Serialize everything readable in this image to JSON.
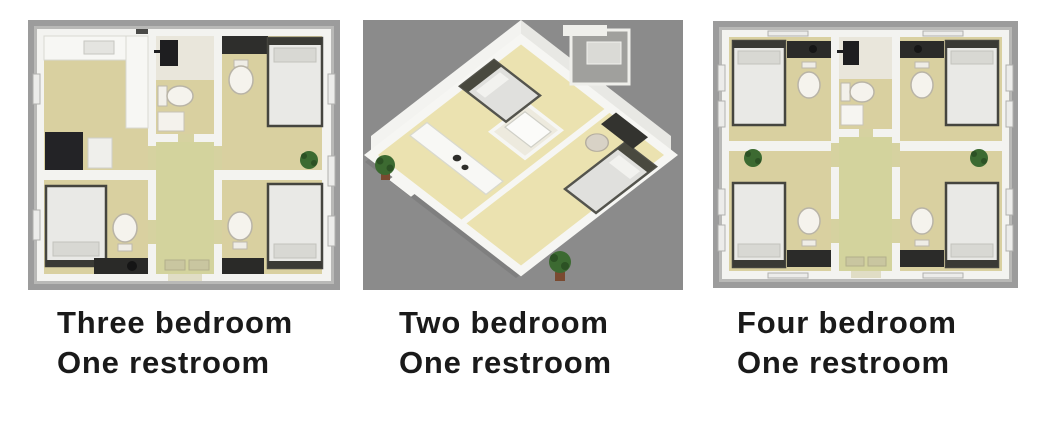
{
  "page": {
    "background_color": "#ffffff"
  },
  "panels": [
    {
      "name": "three-bedroom-plan",
      "view": "top-down floor plan",
      "caption_line1": "Three bedroom",
      "caption_line2": "One restroom",
      "features": [
        "bed-icon",
        "toilet-icon",
        "kitchen-counter-icon",
        "cabinet-icon",
        "plant-icon",
        "water-heater-icon",
        "corridor",
        "bathroom"
      ],
      "colors": {
        "frame": "#9c9c9c",
        "wall": "#f3f3f0",
        "floor": "#d9d0a0",
        "corridor_floor": "#d3d39d"
      }
    },
    {
      "name": "two-bedroom-plan",
      "view": "isometric 3d floor plan",
      "caption_line1": "Two bedroom",
      "caption_line2": "One restroom",
      "features": [
        "bed-icon",
        "kitchen-island-icon",
        "bathroom-sink-icon",
        "desk-icon",
        "chair-icon",
        "plant-icon",
        "entry-door"
      ],
      "colors": {
        "background": "#8b8b8b",
        "floor": "#ebe2b0",
        "wall": "#f3f3f0"
      }
    },
    {
      "name": "four-bedroom-plan",
      "view": "top-down floor plan",
      "caption_line1": "Four bedroom",
      "caption_line2": "One restroom",
      "features": [
        "bed-icon",
        "toilet-icon",
        "vanity-icon",
        "plant-icon",
        "water-heater-icon",
        "corridor",
        "bathroom"
      ],
      "colors": {
        "frame": "#9c9c9c",
        "wall": "#f3f3f0",
        "floor": "#d9d0a0",
        "corridor_floor": "#d3d39d"
      }
    }
  ],
  "caption_style": {
    "color": "#1a1a1a"
  }
}
